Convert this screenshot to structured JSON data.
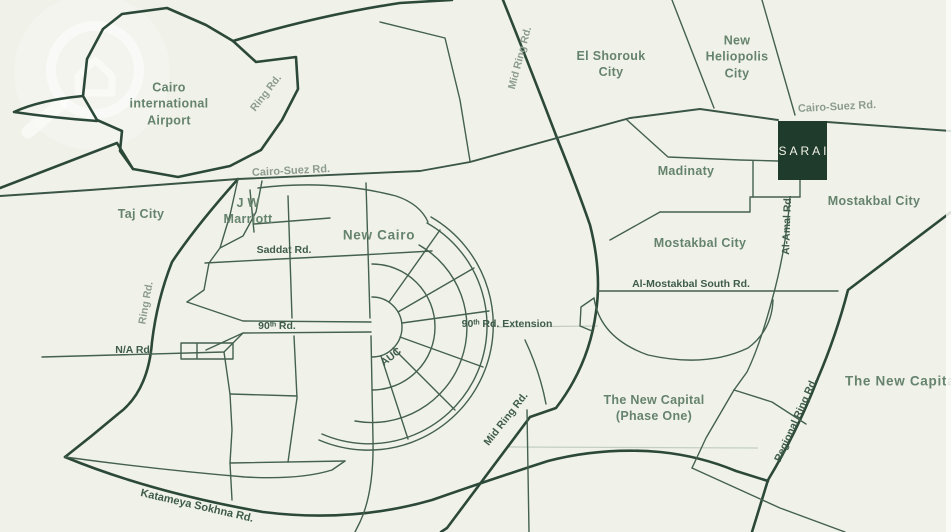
{
  "map": {
    "project": {
      "name": "SARAI"
    },
    "labels": {
      "cairo_airport": "Cairo\ninternational\nAirport",
      "ring_rd_top": "Ring Rd.",
      "mid_ring_top": "Mid Ring Rd.",
      "el_shorouk": "El Shorouk\nCity",
      "new_heliopolis": "New\nHeliopolis\nCity",
      "cairo_suez_left": "Cairo-Suez Rd.",
      "cairo_suez_right": "Cairo-Suez Rd.",
      "madinaty": "Madinaty",
      "mostakbal_city_east": "Mostakbal City",
      "mostakbal_city_west": "Mostakbal City",
      "taj_city": "Taj City",
      "jw_marriott": "J W\nMarriott",
      "saddat_rd": "Saddat Rd.",
      "new_cairo": "New Cairo",
      "al_mostakbal_south_rd": "Al-Mostakbal South Rd.",
      "al_amal_rd": "Al-Amal Rd.",
      "ring_rd_left": "Ring Rd.",
      "na_rd": "N/A Rd.",
      "ninetieth_rd": "90ᵗʰ Rd.",
      "ninetieth_rd_ext": "90ᵗʰ Rd. Extension",
      "auc": "AUC",
      "mid_ring_bottom": "Mid Ring Rd.",
      "new_capital_phase_one": "The New Capital\n(Phase One)",
      "regional_ring_rd": "Regional Ring Rd.",
      "new_capital_east": "The New Capital",
      "katameya_sokhna_rd": "Katameya Sokhna Rd."
    },
    "colors": {
      "background": "#f0f2ea",
      "road_dark": "#2c4838",
      "road": "#44604f",
      "road_light": "#c3cec1",
      "city_label": "#66836d",
      "road_label_dark": "#3f5c4b",
      "road_label_muted": "#8d9b8f",
      "project_box_bg": "#1e3b2c",
      "project_box_text": "#f4f2e7"
    }
  }
}
